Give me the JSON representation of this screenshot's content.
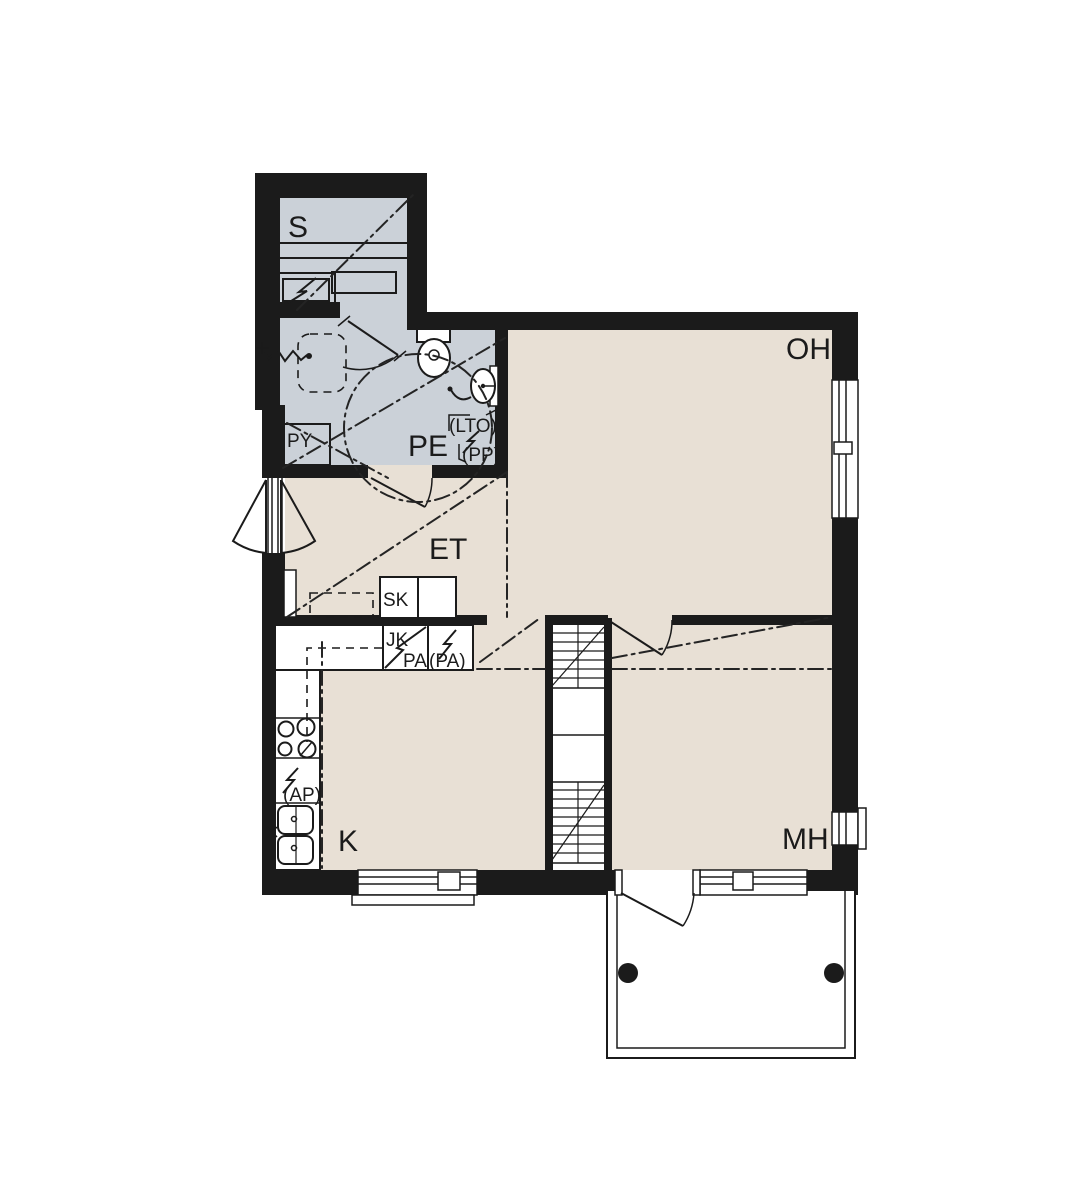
{
  "title": "Apartment floor plan",
  "rooms": {
    "sauna": "S",
    "bathroom": "PE",
    "hallway": "ET",
    "living_room": "OH",
    "kitchen": "K",
    "bedroom": "MH"
  },
  "labels": {
    "laundry_cabinet": "PY",
    "cleaning_cabinet": "SK",
    "fridge": "JK",
    "freezer": "PA",
    "freezer_reservation": "(PA)",
    "heat_recovery_unit": "(LTO)",
    "washing_machine_reservation": "(PP)",
    "dishwasher_reservation": "(AP)"
  },
  "colors": {
    "wall": "#1b1b1b",
    "dry_room_floor": "#e8e0d5",
    "wet_room_floor": "#cbd1d8",
    "background": "#ffffff"
  }
}
